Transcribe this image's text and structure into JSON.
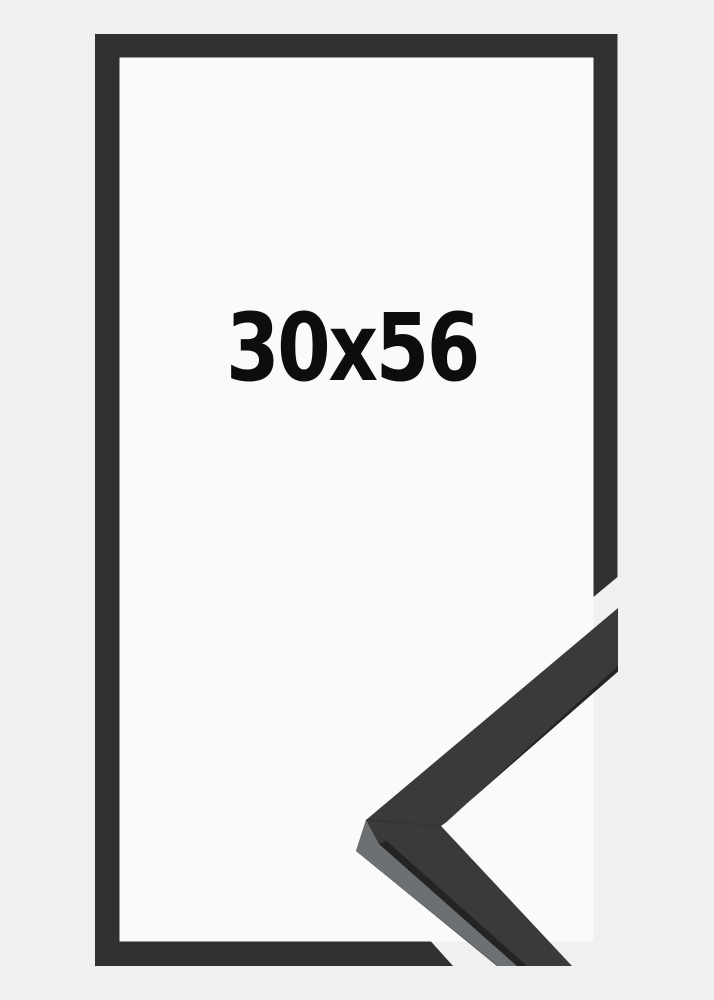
{
  "product": {
    "size_label": "30x56",
    "description": "picture-frame size schematic with molding corner detail",
    "colors": {
      "background": "#f0f0f1",
      "frame_interior": "#fafafa",
      "frame_flat": "#313131",
      "profile_face": "#3a3a3a",
      "profile_side_light": "#6d7073",
      "profile_edge_dark": "#242424",
      "label_text": "#0d0d0d"
    }
  }
}
